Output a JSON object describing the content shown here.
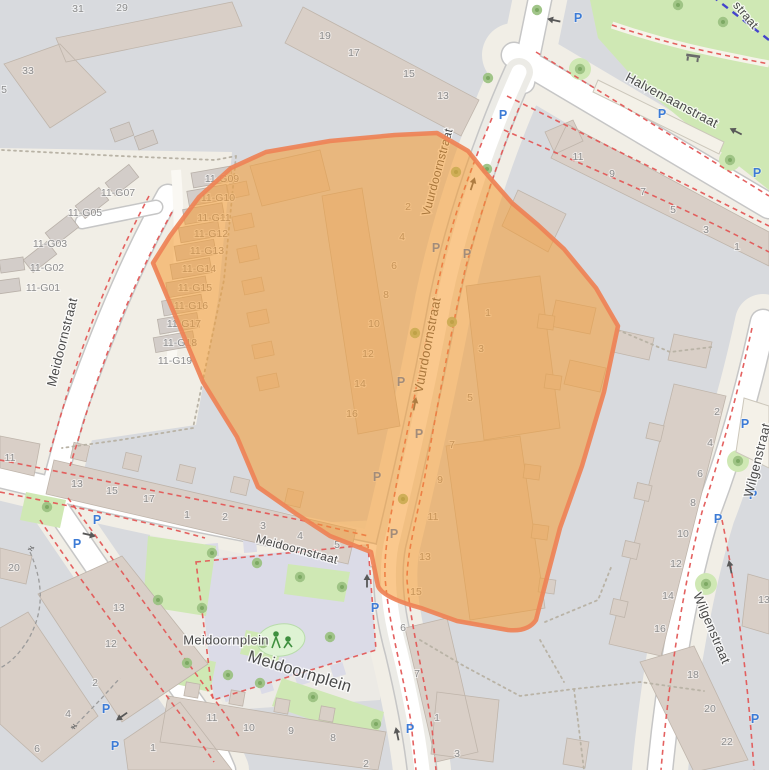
{
  "map": {
    "type": "street-map",
    "highlight": {
      "label": "highlighted-region",
      "fill": "#f59b30",
      "fill_opacity": 0.55,
      "stroke": "#ee8256",
      "stroke_width": 4.5
    },
    "colors": {
      "residential_block": "#d8dade",
      "pedestrian_area": "#f1eee6",
      "street": "#ffffff",
      "building": "#d9cfc7",
      "park": "#cfe8b4",
      "plaza": "#dbdbe7",
      "parking_blue": "#3c7bd6",
      "red_dash": "#e35857",
      "route_dash": "#4444cc",
      "street_text": "#4a4a4a",
      "housenumber_text": "#8c8c8c"
    },
    "street_labels": [
      {
        "text": "Halvemaanstraat",
        "x": 672,
        "y": 100,
        "rotate": 28,
        "size": 13
      },
      {
        "text": "Vuurdoornstraat",
        "x": 437,
        "y": 172,
        "rotate": -75,
        "size": 12
      },
      {
        "text": "Vuurdoornstraat",
        "x": 427,
        "y": 345,
        "rotate": -79,
        "size": 13
      },
      {
        "text": "Meidoornstraat",
        "x": 62,
        "y": 342,
        "rotate": -76,
        "size": 13
      },
      {
        "text": "Meidoornstraat",
        "x": 297,
        "y": 549,
        "rotate": 15,
        "size": 12
      },
      {
        "text": "Meidoornplein",
        "x": 226,
        "y": 640,
        "rotate": 0,
        "size": 13
      },
      {
        "text": "Meidoornplein",
        "x": 300,
        "y": 671,
        "rotate": 17,
        "size": 16.5
      },
      {
        "text": "Wilgenstraat",
        "x": 757,
        "y": 460,
        "rotate": -76,
        "size": 13
      },
      {
        "text": "Wilgenstraat",
        "x": 712,
        "y": 628,
        "rotate": 67,
        "size": 13
      },
      {
        "text": "straat",
        "x": 746,
        "y": 15,
        "rotate": 50,
        "size": 12
      }
    ],
    "house_numbers": [
      {
        "t": "31",
        "x": 78,
        "y": 8
      },
      {
        "t": "29",
        "x": 122,
        "y": 7
      },
      {
        "t": "33",
        "x": 28,
        "y": 70
      },
      {
        "t": "5",
        "x": 4,
        "y": 89
      },
      {
        "t": "19",
        "x": 325,
        "y": 35
      },
      {
        "t": "17",
        "x": 354,
        "y": 52
      },
      {
        "t": "15",
        "x": 409,
        "y": 73
      },
      {
        "t": "13",
        "x": 443,
        "y": 95
      },
      {
        "t": "11-G09",
        "x": 222,
        "y": 178
      },
      {
        "t": "11-G10",
        "x": 218,
        "y": 197
      },
      {
        "t": "11-G11",
        "x": 214,
        "y": 217
      },
      {
        "t": "11-G12",
        "x": 211,
        "y": 233
      },
      {
        "t": "11-G13",
        "x": 207,
        "y": 250
      },
      {
        "t": "11-G14",
        "x": 199,
        "y": 268
      },
      {
        "t": "11-G15",
        "x": 195,
        "y": 287
      },
      {
        "t": "11-G16",
        "x": 191,
        "y": 305
      },
      {
        "t": "11-G17",
        "x": 184,
        "y": 323
      },
      {
        "t": "11-G18",
        "x": 180,
        "y": 342
      },
      {
        "t": "11-G19",
        "x": 175,
        "y": 360
      },
      {
        "t": "11-G07",
        "x": 118,
        "y": 192
      },
      {
        "t": "11-G05",
        "x": 85,
        "y": 212
      },
      {
        "t": "11-G03",
        "x": 50,
        "y": 243
      },
      {
        "t": "11-G02",
        "x": 47,
        "y": 267
      },
      {
        "t": "11-G01",
        "x": 43,
        "y": 287
      },
      {
        "t": "2",
        "x": 408,
        "y": 206
      },
      {
        "t": "4",
        "x": 402,
        "y": 236
      },
      {
        "t": "6",
        "x": 394,
        "y": 265
      },
      {
        "t": "8",
        "x": 386,
        "y": 294
      },
      {
        "t": "10",
        "x": 374,
        "y": 323
      },
      {
        "t": "12",
        "x": 368,
        "y": 353
      },
      {
        "t": "14",
        "x": 360,
        "y": 383
      },
      {
        "t": "16",
        "x": 352,
        "y": 413
      },
      {
        "t": "1",
        "x": 488,
        "y": 312
      },
      {
        "t": "3",
        "x": 481,
        "y": 348
      },
      {
        "t": "5",
        "x": 470,
        "y": 397
      },
      {
        "t": "7",
        "x": 452,
        "y": 444
      },
      {
        "t": "9",
        "x": 440,
        "y": 479
      },
      {
        "t": "11",
        "x": 433,
        "y": 516
      },
      {
        "t": "13",
        "x": 425,
        "y": 556
      },
      {
        "t": "15",
        "x": 416,
        "y": 591
      },
      {
        "t": "11",
        "x": 578,
        "y": 156
      },
      {
        "t": "9",
        "x": 612,
        "y": 173
      },
      {
        "t": "7",
        "x": 643,
        "y": 191
      },
      {
        "t": "5",
        "x": 673,
        "y": 209
      },
      {
        "t": "3",
        "x": 706,
        "y": 229
      },
      {
        "t": "1",
        "x": 737,
        "y": 246
      },
      {
        "t": "2",
        "x": 717,
        "y": 411
      },
      {
        "t": "4",
        "x": 710,
        "y": 442
      },
      {
        "t": "6",
        "x": 700,
        "y": 473
      },
      {
        "t": "8",
        "x": 693,
        "y": 502
      },
      {
        "t": "10",
        "x": 683,
        "y": 533
      },
      {
        "t": "12",
        "x": 676,
        "y": 563
      },
      {
        "t": "14",
        "x": 668,
        "y": 595
      },
      {
        "t": "16",
        "x": 660,
        "y": 628
      },
      {
        "t": "13",
        "x": 764,
        "y": 599
      },
      {
        "t": "18",
        "x": 693,
        "y": 674
      },
      {
        "t": "20",
        "x": 710,
        "y": 708
      },
      {
        "t": "22",
        "x": 727,
        "y": 741
      },
      {
        "t": "11",
        "x": 10,
        "y": 457
      },
      {
        "t": "13",
        "x": 77,
        "y": 483
      },
      {
        "t": "15",
        "x": 112,
        "y": 490
      },
      {
        "t": "17",
        "x": 149,
        "y": 498
      },
      {
        "t": "1",
        "x": 187,
        "y": 514
      },
      {
        "t": "2",
        "x": 225,
        "y": 516
      },
      {
        "t": "3",
        "x": 263,
        "y": 525
      },
      {
        "t": "4",
        "x": 300,
        "y": 535
      },
      {
        "t": "5",
        "x": 337,
        "y": 544
      },
      {
        "t": "20",
        "x": 14,
        "y": 567
      },
      {
        "t": "13",
        "x": 119,
        "y": 607
      },
      {
        "t": "12",
        "x": 111,
        "y": 643
      },
      {
        "t": "2",
        "x": 95,
        "y": 682
      },
      {
        "t": "4",
        "x": 68,
        "y": 713
      },
      {
        "t": "6",
        "x": 37,
        "y": 748
      },
      {
        "t": "1",
        "x": 153,
        "y": 747
      },
      {
        "t": "11",
        "x": 212,
        "y": 717
      },
      {
        "t": "10",
        "x": 249,
        "y": 727
      },
      {
        "t": "9",
        "x": 291,
        "y": 730
      },
      {
        "t": "8",
        "x": 333,
        "y": 737
      },
      {
        "t": "2",
        "x": 366,
        "y": 763
      },
      {
        "t": "6",
        "x": 403,
        "y": 627
      },
      {
        "t": "7",
        "x": 417,
        "y": 673
      },
      {
        "t": "1",
        "x": 437,
        "y": 717
      },
      {
        "t": "3",
        "x": 457,
        "y": 753
      }
    ],
    "parking_icons": [
      {
        "x": 578,
        "y": 17
      },
      {
        "x": 503,
        "y": 114
      },
      {
        "x": 662,
        "y": 113
      },
      {
        "x": 757,
        "y": 172
      },
      {
        "x": 436,
        "y": 247
      },
      {
        "x": 467,
        "y": 253
      },
      {
        "x": 401,
        "y": 381
      },
      {
        "x": 419,
        "y": 433
      },
      {
        "x": 377,
        "y": 476
      },
      {
        "x": 394,
        "y": 533
      },
      {
        "x": 375,
        "y": 607
      },
      {
        "x": 410,
        "y": 728
      },
      {
        "x": 97,
        "y": 519
      },
      {
        "x": 77,
        "y": 543
      },
      {
        "x": 106,
        "y": 708
      },
      {
        "x": 115,
        "y": 745
      },
      {
        "x": 745,
        "y": 423
      },
      {
        "x": 753,
        "y": 494
      },
      {
        "x": 718,
        "y": 518
      },
      {
        "x": 755,
        "y": 718
      }
    ],
    "trees": [
      {
        "x": 537,
        "y": 10
      },
      {
        "x": 678,
        "y": 5
      },
      {
        "x": 723,
        "y": 22
      },
      {
        "x": 580,
        "y": 69
      },
      {
        "x": 488,
        "y": 78
      },
      {
        "x": 730,
        "y": 160
      },
      {
        "x": 487,
        "y": 169
      },
      {
        "x": 456,
        "y": 172
      },
      {
        "x": 452,
        "y": 322
      },
      {
        "x": 415,
        "y": 333
      },
      {
        "x": 403,
        "y": 499
      },
      {
        "x": 47,
        "y": 507
      },
      {
        "x": 738,
        "y": 461
      },
      {
        "x": 706,
        "y": 584
      },
      {
        "x": 158,
        "y": 600
      },
      {
        "x": 212,
        "y": 553
      },
      {
        "x": 257,
        "y": 563
      },
      {
        "x": 300,
        "y": 577
      },
      {
        "x": 342,
        "y": 587
      },
      {
        "x": 202,
        "y": 608
      },
      {
        "x": 330,
        "y": 637
      },
      {
        "x": 187,
        "y": 663
      },
      {
        "x": 228,
        "y": 675
      },
      {
        "x": 260,
        "y": 683
      },
      {
        "x": 313,
        "y": 697
      },
      {
        "x": 376,
        "y": 724
      },
      {
        "x": 263,
        "y": 643
      }
    ],
    "oneway_arrows": [
      {
        "x": 553,
        "y": 20,
        "rotate": 192
      },
      {
        "x": 735,
        "y": 131,
        "rotate": 207
      },
      {
        "x": 473,
        "y": 183,
        "rotate": -72
      },
      {
        "x": 415,
        "y": 403,
        "rotate": -79
      },
      {
        "x": 367,
        "y": 580,
        "rotate": -90
      },
      {
        "x": 397,
        "y": 733,
        "rotate": -102
      },
      {
        "x": 90,
        "y": 535,
        "rotate": 13
      },
      {
        "x": 121,
        "y": 717,
        "rotate": 145
      },
      {
        "x": 730,
        "y": 566,
        "rotate": -102
      }
    ],
    "gates": [
      {
        "x": 29,
        "y": 551,
        "rotate": 40
      },
      {
        "x": 72,
        "y": 729,
        "rotate": 40
      }
    ],
    "point_icons": [
      {
        "name": "bench-icon",
        "x": 693,
        "y": 57
      },
      {
        "name": "playground-icon",
        "x": 281,
        "y": 640
      }
    ]
  }
}
